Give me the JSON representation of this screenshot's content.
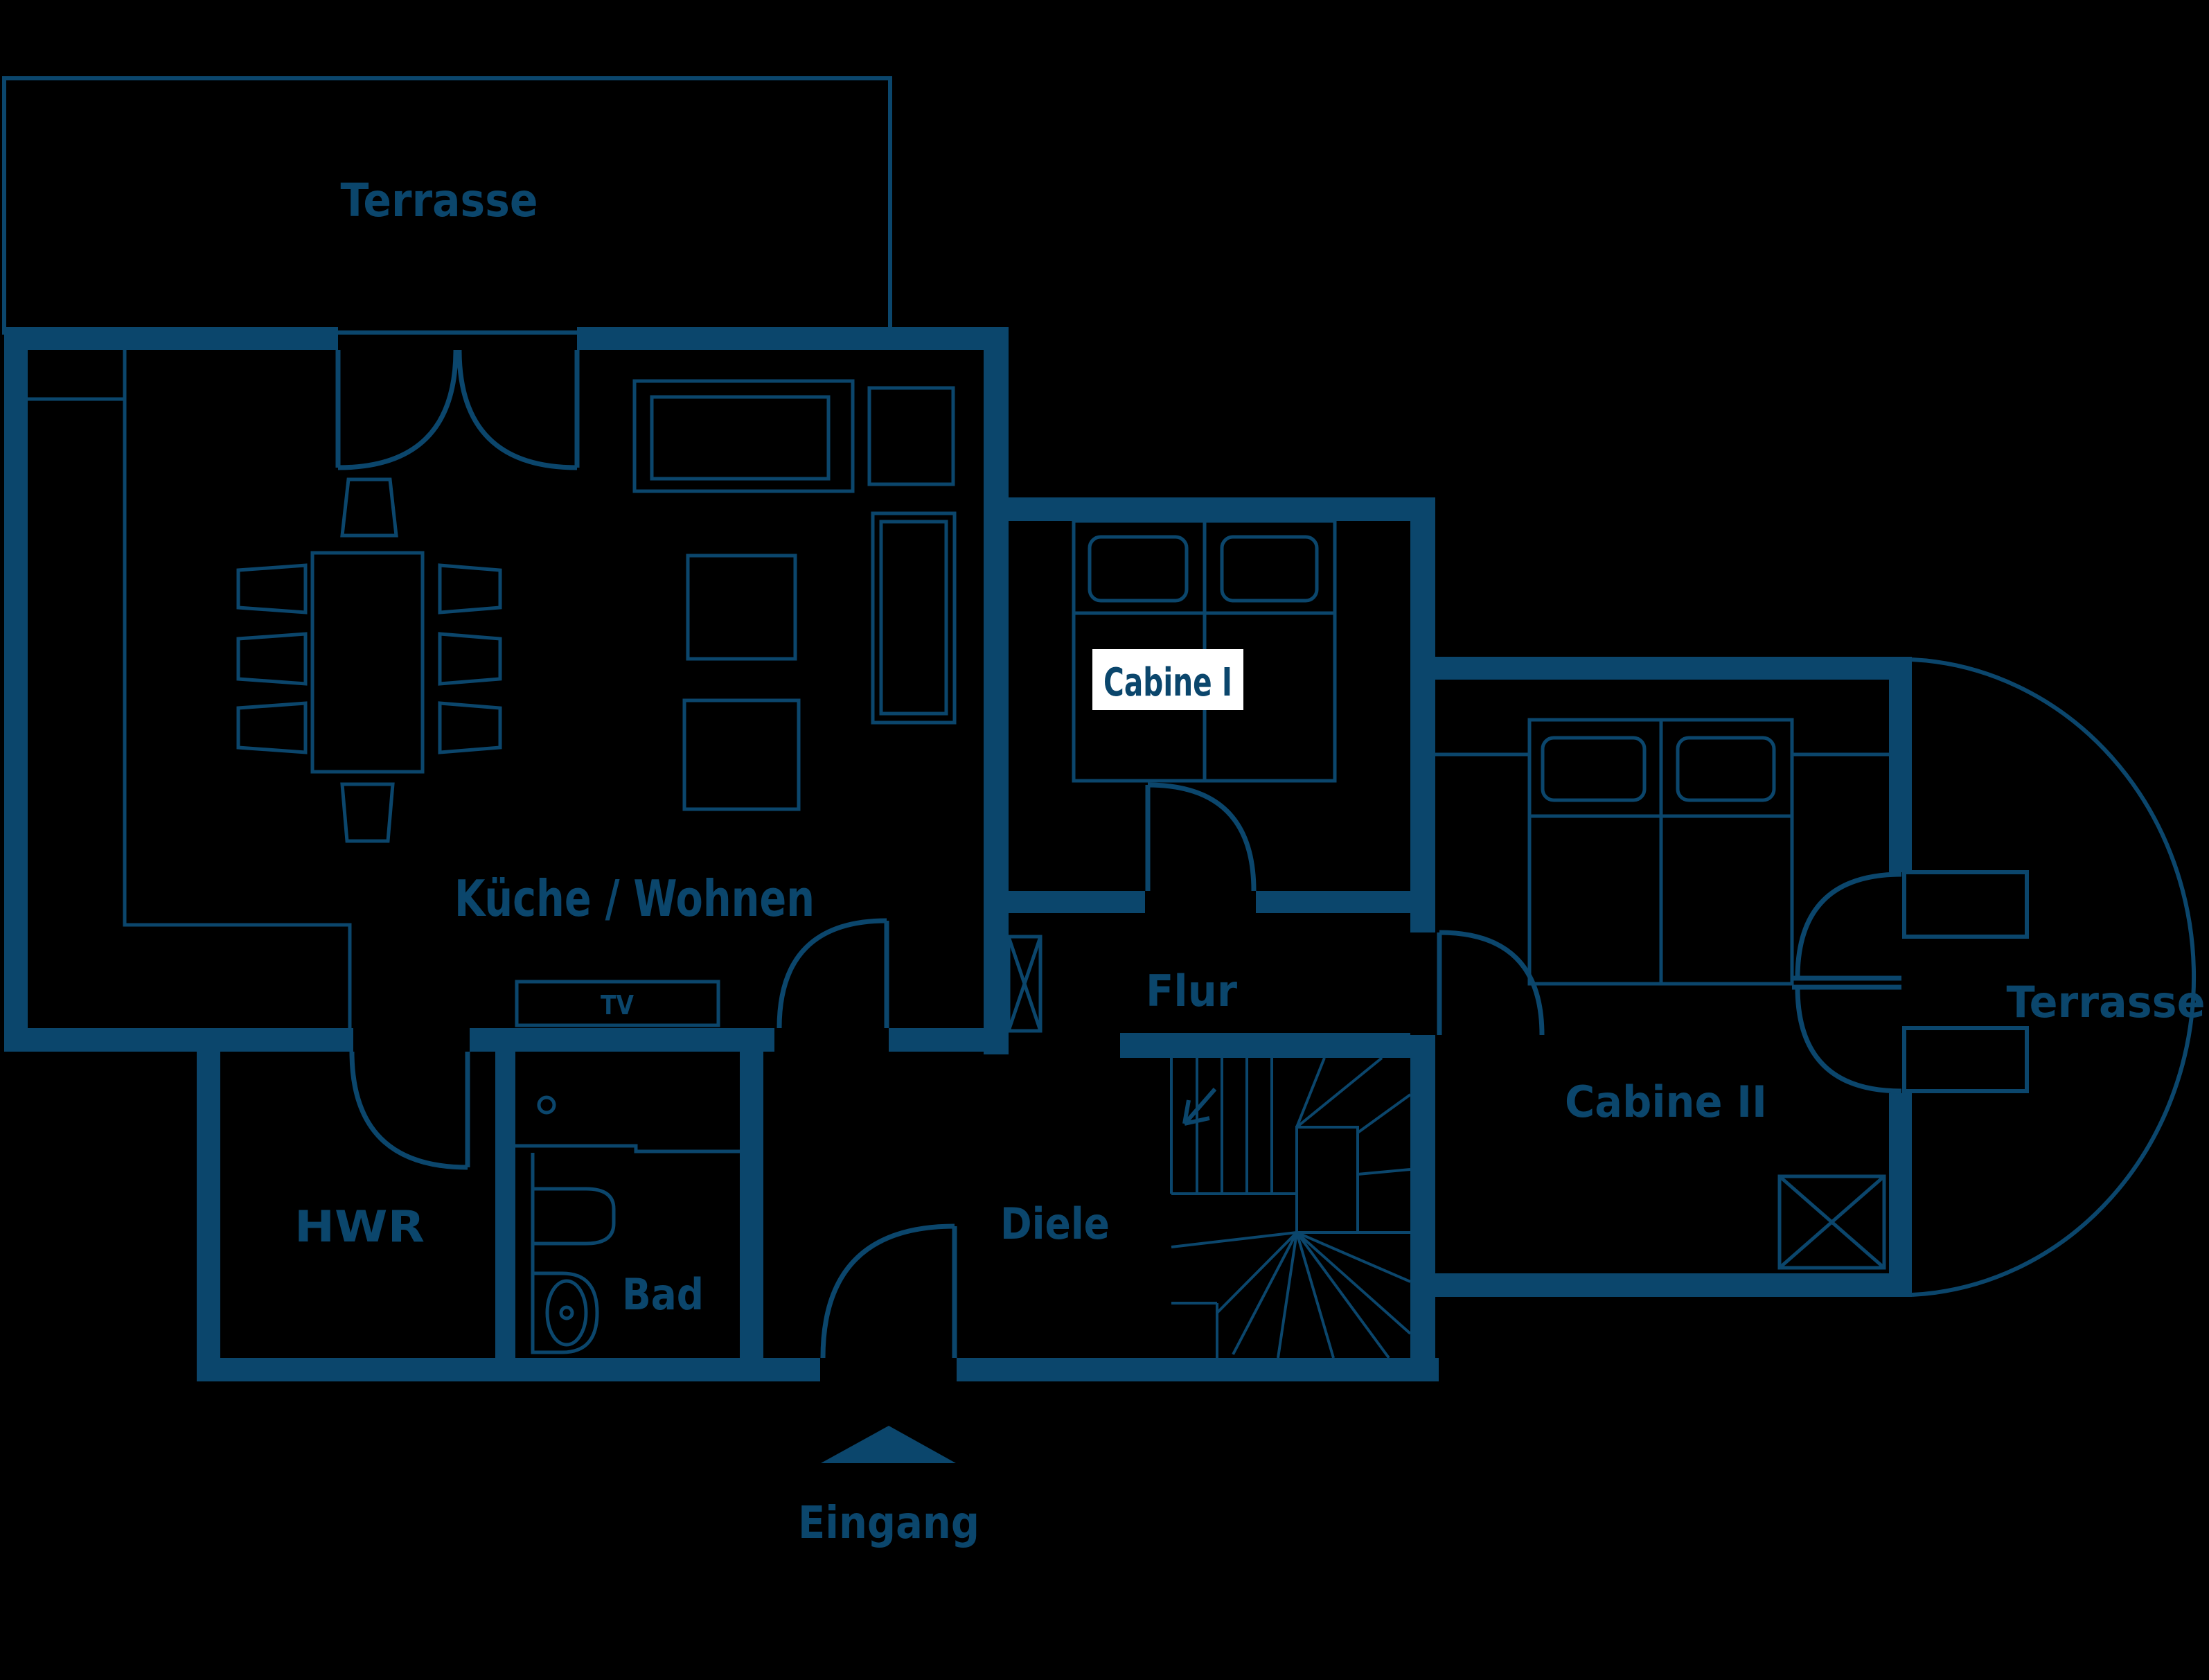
{
  "app": {
    "type": "floor-plan"
  },
  "colors": {
    "background": "#000000",
    "plan_line": "#0b466c",
    "wall_fill": "#0b466c",
    "highlight_bg": "#ffffff",
    "highlight_text": "#0b466c"
  },
  "rooms": {
    "terrace_top": {
      "label": "Terrasse"
    },
    "kitchen_living": {
      "label": "Küche / Wohnen"
    },
    "cabin_1": {
      "label": "Cabine I",
      "highlighted": true
    },
    "cabin_2": {
      "label": "Cabine II"
    },
    "hallway": {
      "label": "Flur"
    },
    "utility": {
      "label": "HWR"
    },
    "bathroom": {
      "label": "Bad"
    },
    "foyer": {
      "label": "Diele"
    },
    "terrace_right": {
      "label": "Terrasse"
    },
    "entrance": {
      "label": "Eingang"
    }
  },
  "furniture": {
    "tv": "TV"
  }
}
